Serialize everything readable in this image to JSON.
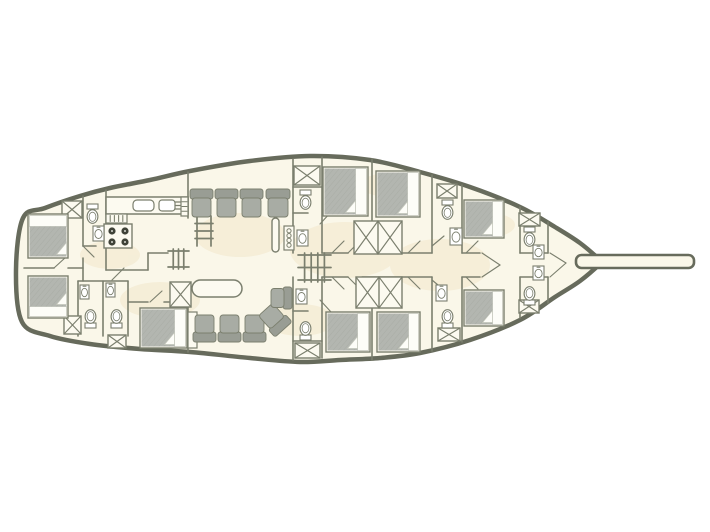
{
  "meta": {
    "type": "boat-deck-plan",
    "description": "Top-view lower deck floor plan of a gulet-style sailing yacht: aft cabins with double beds, galley with stove and sinks, central salon with table and seating, midship and bow guest cabins with en-suite toilets and washbasins, hatch boxes, companionway stairs, mast, and bowsprit at the bow.",
    "canvas": {
      "width": 710,
      "height": 532
    }
  },
  "palette": {
    "background": "#ffffff",
    "hull_fill": "#faf7e9",
    "hull_stroke": "#676b5c",
    "wall": "#7b7f6e",
    "furniture_fill": "#fcfaf0",
    "bed_gray": "#b3b6b0",
    "bed_hatch": "#a2a59d",
    "seat_gray": "#a8aca4",
    "seat_back_gray": "#999d94",
    "burner_dark": "#3f4238",
    "stain": "#f0e2c2",
    "pillow_white": "#fdfdf8"
  },
  "hull": {
    "stroke_width": 4.5,
    "points": [
      [
        23,
        218
      ],
      [
        45,
        208
      ],
      [
        80,
        196
      ],
      [
        110,
        188
      ],
      [
        150,
        180
      ],
      [
        190,
        171
      ],
      [
        250,
        161
      ],
      [
        310,
        156
      ],
      [
        370,
        160
      ],
      [
        420,
        172
      ],
      [
        470,
        187
      ],
      [
        520,
        207
      ],
      [
        555,
        227
      ],
      [
        580,
        243
      ],
      [
        601,
        261
      ],
      [
        601,
        263
      ],
      [
        580,
        281
      ],
      [
        555,
        297
      ],
      [
        520,
        320
      ],
      [
        470,
        340
      ],
      [
        420,
        353
      ],
      [
        380,
        358
      ],
      [
        340,
        360
      ],
      [
        300,
        362
      ],
      [
        250,
        358
      ],
      [
        190,
        352
      ],
      [
        140,
        349
      ],
      [
        90,
        344
      ],
      [
        50,
        336
      ],
      [
        22,
        322
      ],
      [
        16,
        270
      ]
    ]
  },
  "bowsprit": {
    "x": 576,
    "y": 255,
    "w": 118,
    "h": 13,
    "rx": 5.5
  },
  "stains": [
    {
      "cx": 240,
      "cy": 235,
      "rx": 45,
      "ry": 22
    },
    {
      "cx": 345,
      "cy": 250,
      "rx": 55,
      "ry": 28
    },
    {
      "cx": 440,
      "cy": 265,
      "rx": 50,
      "ry": 26
    },
    {
      "cx": 160,
      "cy": 300,
      "rx": 40,
      "ry": 18
    },
    {
      "cx": 390,
      "cy": 185,
      "rx": 30,
      "ry": 12
    },
    {
      "cx": 300,
      "cy": 320,
      "rx": 35,
      "ry": 16
    },
    {
      "cx": 490,
      "cy": 225,
      "rx": 25,
      "ry": 12
    },
    {
      "cx": 110,
      "cy": 255,
      "rx": 30,
      "ry": 14
    }
  ],
  "walls": [
    [
      24,
      268,
      54,
      268
    ],
    [
      68,
      268,
      83,
      268
    ],
    [
      83,
      196,
      83,
      246
    ],
    [
      83,
      258,
      83,
      281
    ],
    [
      106,
      190,
      106,
      270
    ],
    [
      83,
      246,
      96,
      246
    ],
    [
      106,
      270,
      148,
      270
    ],
    [
      148,
      253,
      148,
      270
    ],
    [
      148,
      253,
      168,
      253
    ],
    [
      78,
      281,
      128,
      281
    ],
    [
      78,
      281,
      78,
      336
    ],
    [
      103,
      281,
      103,
      336
    ],
    [
      128,
      281,
      128,
      336
    ],
    [
      128,
      302,
      148,
      302
    ],
    [
      164,
      302,
      188,
      302
    ],
    [
      188,
      172,
      188,
      218
    ],
    [
      188,
      302,
      188,
      352
    ],
    [
      293,
      159,
      293,
      253
    ],
    [
      322,
      157,
      322,
      253
    ],
    [
      293,
      277,
      293,
      360
    ],
    [
      322,
      277,
      322,
      358
    ],
    [
      293,
      187,
      322,
      187
    ],
    [
      293,
      213,
      308,
      213
    ],
    [
      293,
      341,
      322,
      341
    ],
    [
      293,
      311,
      308,
      311
    ],
    [
      372,
      159,
      372,
      221
    ],
    [
      372,
      307,
      372,
      360
    ],
    [
      322,
      253,
      348,
      253
    ],
    [
      362,
      253,
      432,
      253
    ],
    [
      322,
      277,
      348,
      277
    ],
    [
      362,
      277,
      432,
      277
    ],
    [
      432,
      175,
      432,
      253
    ],
    [
      432,
      277,
      432,
      351
    ],
    [
      462,
      185,
      462,
      253
    ],
    [
      462,
      277,
      462,
      342
    ],
    [
      520,
      207,
      520,
      253
    ],
    [
      520,
      277,
      520,
      318
    ],
    [
      548,
      222,
      548,
      253
    ],
    [
      548,
      277,
      548,
      303
    ],
    [
      462,
      253,
      480,
      253
    ],
    [
      462,
      277,
      480,
      277
    ],
    [
      520,
      253,
      548,
      253
    ],
    [
      520,
      277,
      548,
      277
    ]
  ],
  "doors": [
    [
      54,
      268,
      66,
      257
    ],
    [
      83,
      246,
      94,
      257
    ],
    [
      112,
      280,
      124,
      268
    ],
    [
      150,
      302,
      162,
      291
    ],
    [
      320,
      224,
      331,
      212
    ],
    [
      320,
      300,
      331,
      312
    ],
    [
      332,
      253,
      344,
      241
    ],
    [
      332,
      277,
      344,
      289
    ],
    [
      348,
      253,
      358,
      243
    ],
    [
      348,
      277,
      358,
      287
    ],
    [
      408,
      253,
      420,
      241
    ],
    [
      408,
      277,
      420,
      289
    ],
    [
      432,
      246,
      444,
      236
    ],
    [
      432,
      280,
      444,
      290
    ],
    [
      466,
      253,
      478,
      241
    ],
    [
      466,
      277,
      478,
      289
    ],
    [
      482,
      253,
      500,
      265
    ],
    [
      482,
      277,
      500,
      265
    ],
    [
      550,
      253,
      566,
      263
    ],
    [
      550,
      277,
      566,
      263
    ]
  ],
  "beds": [
    {
      "x": 28,
      "y": 214,
      "w": 40,
      "h": 44,
      "pillow": "top"
    },
    {
      "x": 28,
      "y": 276,
      "w": 40,
      "h": 42,
      "pillow": "bottom"
    },
    {
      "x": 140,
      "y": 308,
      "w": 47,
      "h": 40,
      "pillow": "right"
    },
    {
      "x": 323,
      "y": 167,
      "w": 45,
      "h": 49,
      "pillow": "right"
    },
    {
      "x": 376,
      "y": 171,
      "w": 44,
      "h": 46,
      "pillow": "right"
    },
    {
      "x": 326,
      "y": 312,
      "w": 44,
      "h": 40,
      "pillow": "right"
    },
    {
      "x": 377,
      "y": 312,
      "w": 43,
      "h": 40,
      "pillow": "right"
    },
    {
      "x": 464,
      "y": 200,
      "w": 40,
      "h": 38,
      "pillow": "right"
    },
    {
      "x": 464,
      "y": 290,
      "w": 40,
      "h": 36,
      "pillow": "right"
    }
  ],
  "seats": [
    {
      "x": 190,
      "y": 189,
      "w": 23,
      "h": 28,
      "back": "top",
      "rot": 0
    },
    {
      "x": 215,
      "y": 189,
      "w": 23,
      "h": 28,
      "back": "top",
      "rot": 0
    },
    {
      "x": 240,
      "y": 189,
      "w": 23,
      "h": 28,
      "back": "top",
      "rot": 0
    },
    {
      "x": 266,
      "y": 189,
      "w": 24,
      "h": 28,
      "back": "top",
      "rot": 0
    },
    {
      "x": 193,
      "y": 315,
      "w": 23,
      "h": 27,
      "back": "bottom",
      "rot": 0
    },
    {
      "x": 218,
      "y": 315,
      "w": 23,
      "h": 27,
      "back": "bottom",
      "rot": 0
    },
    {
      "x": 243,
      "y": 315,
      "w": 23,
      "h": 27,
      "back": "bottom",
      "rot": 0
    },
    {
      "x": 263,
      "y": 306,
      "w": 23,
      "h": 27,
      "back": "bottom",
      "rot": -42
    },
    {
      "x": 271,
      "y": 287,
      "w": 21,
      "h": 22,
      "back": "right",
      "rot": 0
    }
  ],
  "toilets": [
    {
      "x": 86,
      "y": 204,
      "dir": "down"
    },
    {
      "x": 84,
      "y": 310,
      "dir": "up"
    },
    {
      "x": 110,
      "y": 310,
      "dir": "up"
    },
    {
      "x": 299,
      "y": 190,
      "dir": "down"
    },
    {
      "x": 299,
      "y": 322,
      "dir": "up"
    },
    {
      "x": 441,
      "y": 200,
      "dir": "down"
    },
    {
      "x": 441,
      "y": 310,
      "dir": "up"
    },
    {
      "x": 523,
      "y": 227,
      "dir": "down"
    },
    {
      "x": 523,
      "y": 287,
      "dir": "up"
    }
  ],
  "sinks": [
    {
      "x": 93,
      "y": 226,
      "w": 11,
      "h": 15
    },
    {
      "x": 80,
      "y": 285,
      "w": 9,
      "h": 14
    },
    {
      "x": 106,
      "y": 283,
      "w": 9,
      "h": 14
    },
    {
      "x": 297,
      "y": 230,
      "w": 11,
      "h": 16
    },
    {
      "x": 296,
      "y": 289,
      "w": 11,
      "h": 15
    },
    {
      "x": 450,
      "y": 228,
      "w": 12,
      "h": 17
    },
    {
      "x": 436,
      "y": 285,
      "w": 11,
      "h": 16
    },
    {
      "x": 533,
      "y": 245,
      "w": 11,
      "h": 14
    },
    {
      "x": 533,
      "y": 266,
      "w": 11,
      "h": 14
    }
  ],
  "xboxes": [
    {
      "x": 62,
      "y": 201,
      "w": 20,
      "h": 17,
      "cells": 1
    },
    {
      "x": 64,
      "y": 316,
      "w": 17,
      "h": 18,
      "cells": 1
    },
    {
      "x": 108,
      "y": 335,
      "w": 18,
      "h": 13,
      "cells": 1
    },
    {
      "x": 170,
      "y": 282,
      "w": 21,
      "h": 25,
      "cells": 1
    },
    {
      "x": 294,
      "y": 166,
      "w": 26,
      "h": 19,
      "cells": 1
    },
    {
      "x": 295,
      "y": 343,
      "w": 25,
      "h": 15,
      "cells": 1
    },
    {
      "x": 354,
      "y": 221,
      "w": 48,
      "h": 33,
      "cells": 2
    },
    {
      "x": 356,
      "y": 277,
      "w": 46,
      "h": 31,
      "cells": 2
    },
    {
      "x": 437,
      "y": 184,
      "w": 20,
      "h": 14,
      "cells": 1
    },
    {
      "x": 438,
      "y": 328,
      "w": 22,
      "h": 13,
      "cells": 1
    },
    {
      "x": 519,
      "y": 213,
      "w": 21,
      "h": 13,
      "cells": 1
    },
    {
      "x": 519,
      "y": 300,
      "w": 20,
      "h": 13,
      "cells": 1
    }
  ],
  "ladders": [
    {
      "x": 197,
      "y": 216,
      "w": 14,
      "h": 30,
      "orient": "v",
      "rungs": 3,
      "rails": 2
    },
    {
      "x": 168,
      "y": 251,
      "w": 21,
      "h": 16,
      "orient": "h",
      "rungs": 3,
      "rails": 2
    },
    {
      "x": 298,
      "y": 255,
      "w": 33,
      "h": 25,
      "orient": "h",
      "rungs": 4,
      "rails": 3
    }
  ],
  "galley": {
    "counter": {
      "x": 106,
      "y": 197,
      "w": 82,
      "h": 17
    },
    "counter_sinks": [
      {
        "x": 133,
        "y": 200,
        "w": 21,
        "h": 11,
        "rx": 4
      },
      {
        "x": 159,
        "y": 200,
        "w": 16,
        "h": 11,
        "rx": 3
      }
    ],
    "grill": {
      "x": 175,
      "y": 202,
      "w": 10,
      "lines": 3,
      "gap": 3.5
    },
    "vent": {
      "x": 106,
      "y": 214,
      "w": 21,
      "h": 9,
      "ticks": 4
    },
    "stove": {
      "x": 104,
      "y": 224,
      "w": 28,
      "h": 24,
      "r": 3.6,
      "burners": [
        [
          112,
          231
        ],
        [
          125,
          231
        ],
        [
          112,
          242
        ],
        [
          125,
          242
        ]
      ]
    }
  },
  "table": {
    "x": 192,
    "y": 280,
    "w": 50,
    "h": 17,
    "rx": 8.5
  },
  "mast": {
    "x": 272,
    "y": 218,
    "w": 7,
    "h": 34,
    "rx": 3.5
  },
  "vanity": {
    "x": 284,
    "y": 226,
    "w": 10,
    "h": 24,
    "circles": 4
  },
  "cabinets": [
    {
      "x": 181,
      "y": 197,
      "w": 7,
      "h": 19,
      "lines": 3
    },
    {
      "x": 188,
      "y": 312,
      "w": 9,
      "h": 36,
      "lines": 0
    }
  ]
}
